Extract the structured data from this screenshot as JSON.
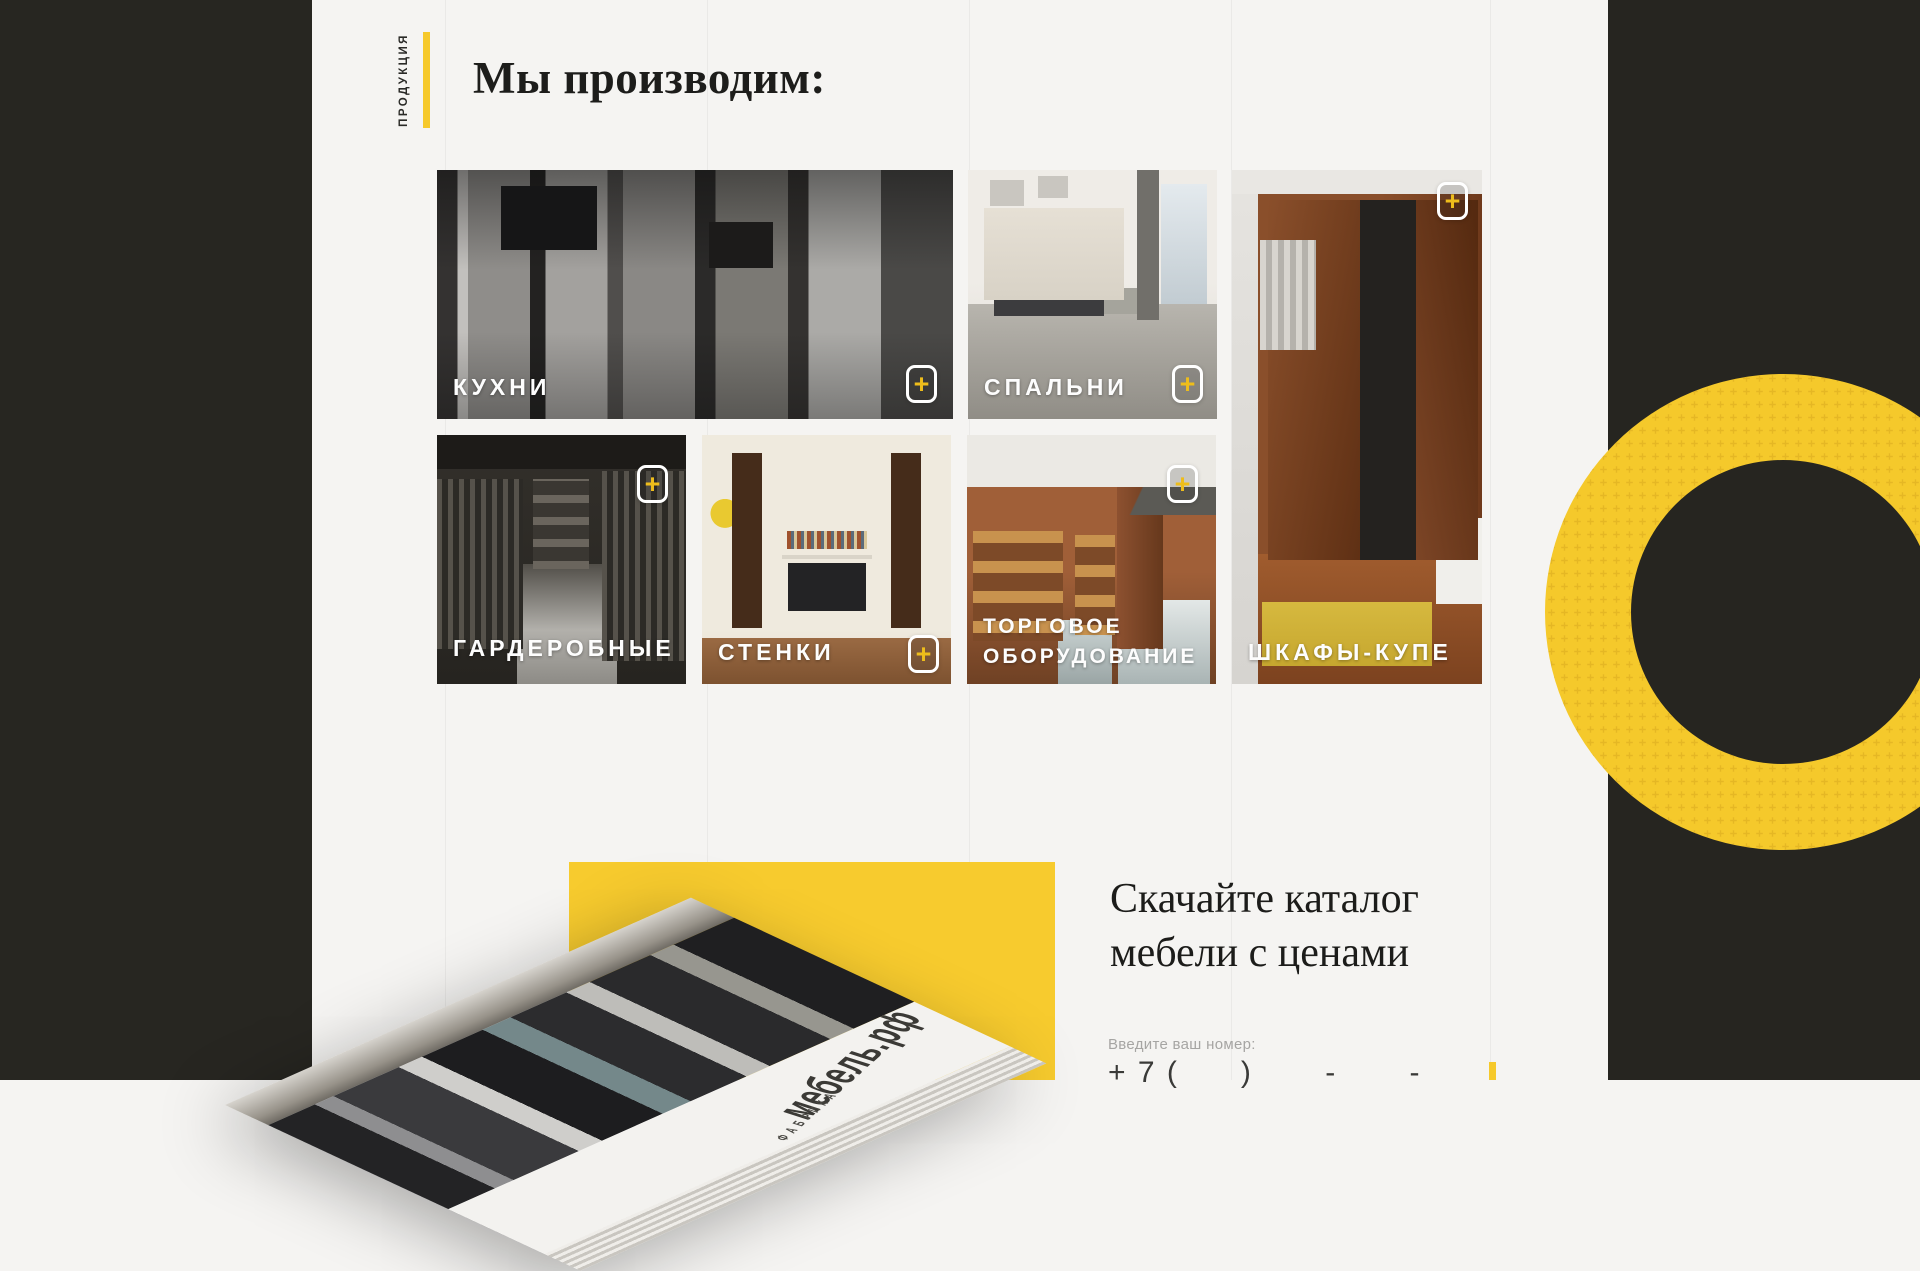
{
  "colors": {
    "accent": "#f6c92b",
    "band": "#262520",
    "background": "#f5f4f2"
  },
  "products": {
    "side_label": "ПРОДУКЦИЯ",
    "title": "Мы производим:",
    "plus_glyph": "+",
    "categories": [
      {
        "label": "КУХНИ"
      },
      {
        "label": "СПАЛЬНИ"
      },
      {
        "label": "ШКАФЫ-КУПЕ"
      },
      {
        "label": "ГАРДЕРОБНЫЕ"
      },
      {
        "label": "СТЕНКИ"
      },
      {
        "label": "ТОРГОВОЕ ОБОРУДОВАНИЕ"
      }
    ]
  },
  "catalog": {
    "heading_line1": "Скачайте каталог",
    "heading_line2": "мебели с ценами",
    "phone_label": "Введите ваш номер:",
    "phone_mask": "+ 7 (      )       -       -",
    "book_brand": "мебель.рф",
    "book_sub": "фабрика"
  }
}
